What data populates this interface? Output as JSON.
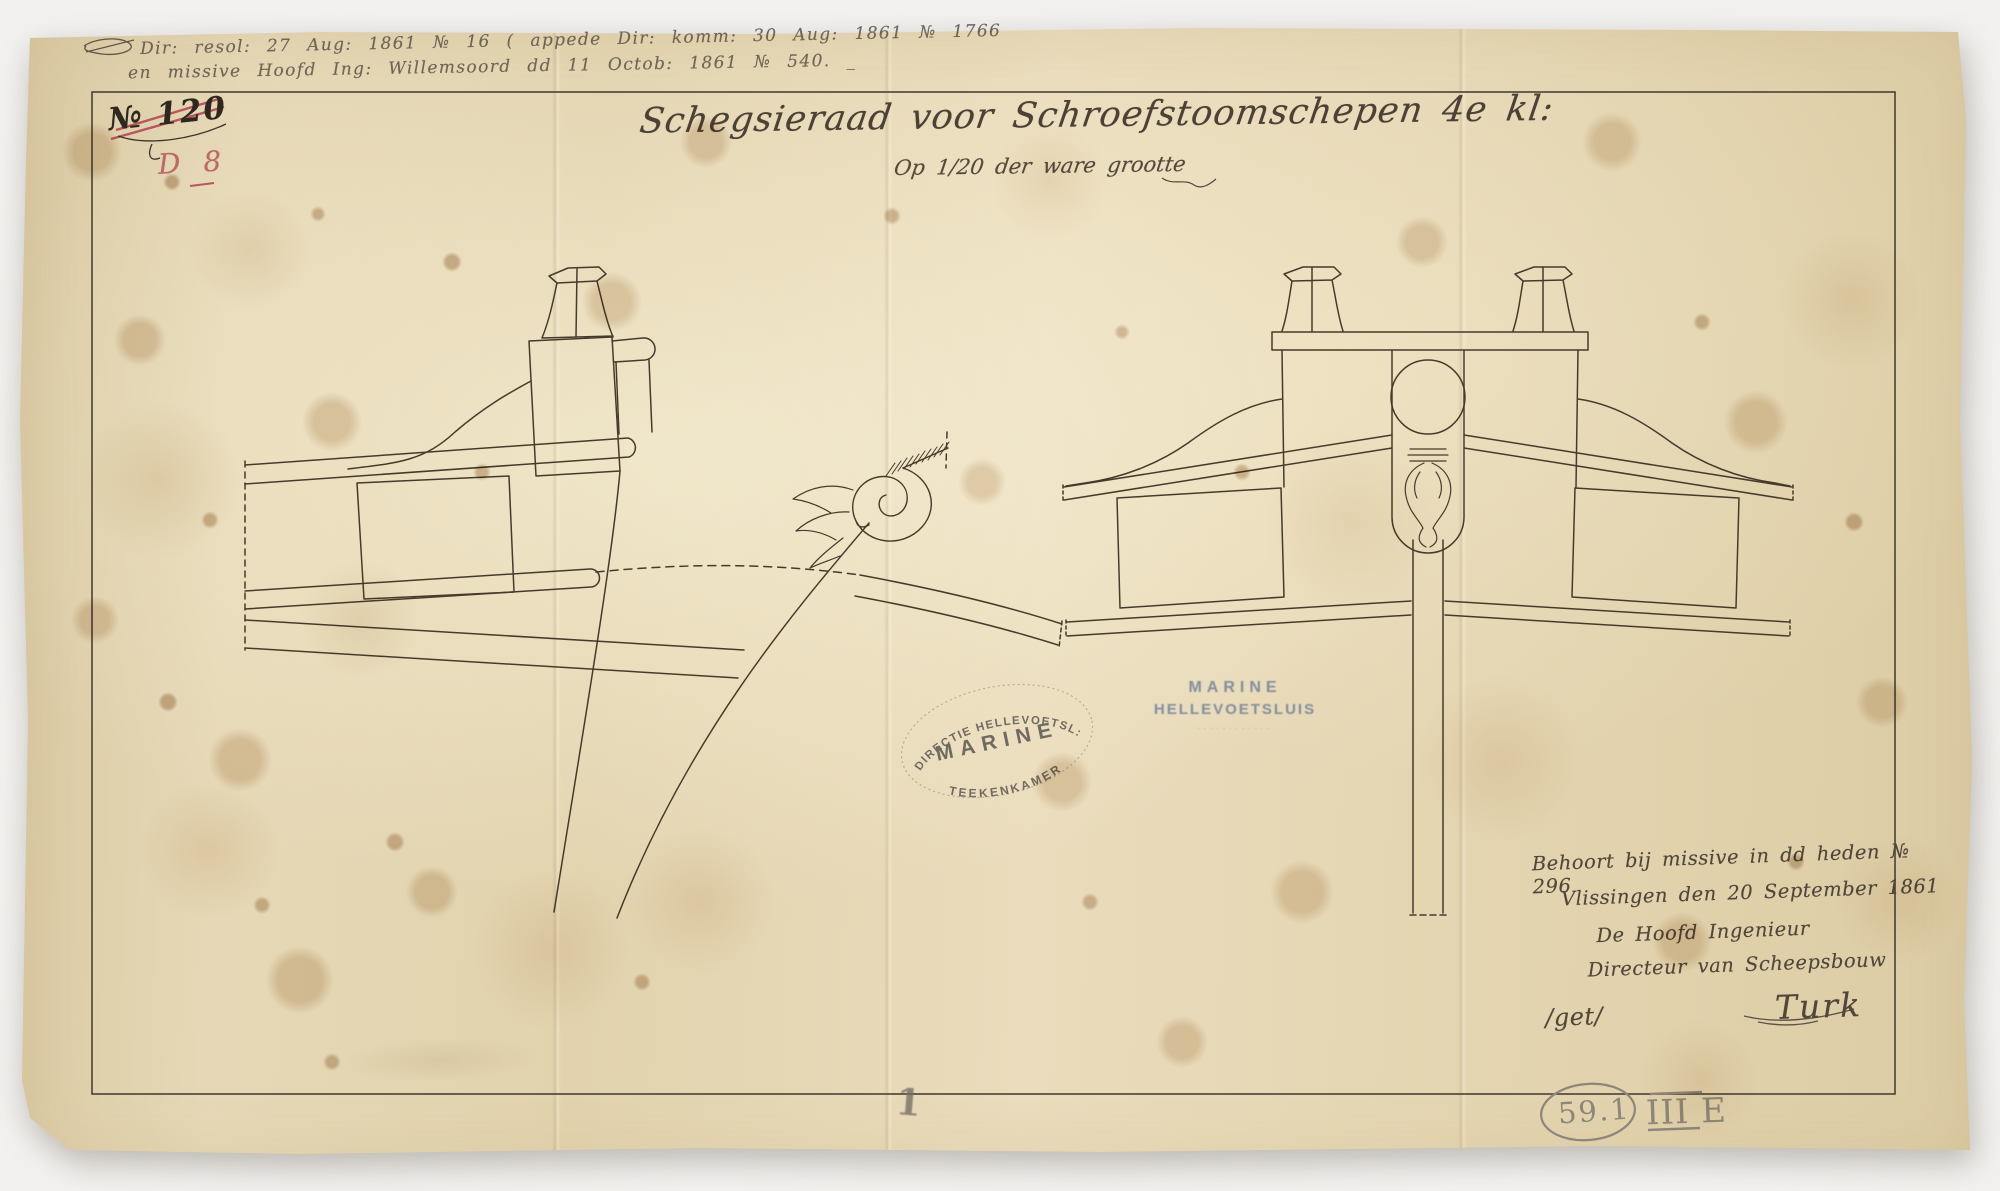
{
  "colors": {
    "background": "#f2f1ef",
    "paper_base": "#e4d5b1",
    "ink_drawing": "#463b2b",
    "ink_handwriting": "#50463a",
    "red_crayon": "#b9565e",
    "pencil": "#8d867a",
    "stamp_black": "#4e4b47",
    "stamp_blue": "#6c7c98",
    "frame_line": "#4a4136"
  },
  "top_annotations": {
    "line1": "Dir: resol: 27 Aug: 1861 № 16 ( appede Dir: komm: 30 Aug: 1861 № 1766",
    "line2": "en missive Hoofd Ing: Willemsoord dd 11 Octob: 1861 № 540. _"
  },
  "number_block": {
    "crossed_number": "№ 120",
    "red_code": "D 8"
  },
  "title": {
    "main": "Schegsieraad voor Schroefstoomschepen 4e kl:",
    "scale_note": "Op 1/20 der ware grootte"
  },
  "stamps": {
    "oval": {
      "top_arc": "DIRECTIE HELLEVOETSL:",
      "middle": "MARINE",
      "bottom_arc": "TEEKENKAMER"
    },
    "blue": {
      "line1": "MARINE",
      "line2": "HELLEVOETSLUIS",
      "line3": "············"
    }
  },
  "signature_block": {
    "line1": "Behoort bij missive in dd heden № 296",
    "line2": "Vlissingen den 20 September 1861",
    "line3": "De Hoofd Ingenieur",
    "line4": "Directeur van Scheepsbouw",
    "get_mark": "/get/",
    "signature": "Turk"
  },
  "archive_codes": {
    "circled": "59.1",
    "series": "III E",
    "bottom_mark": "1"
  }
}
